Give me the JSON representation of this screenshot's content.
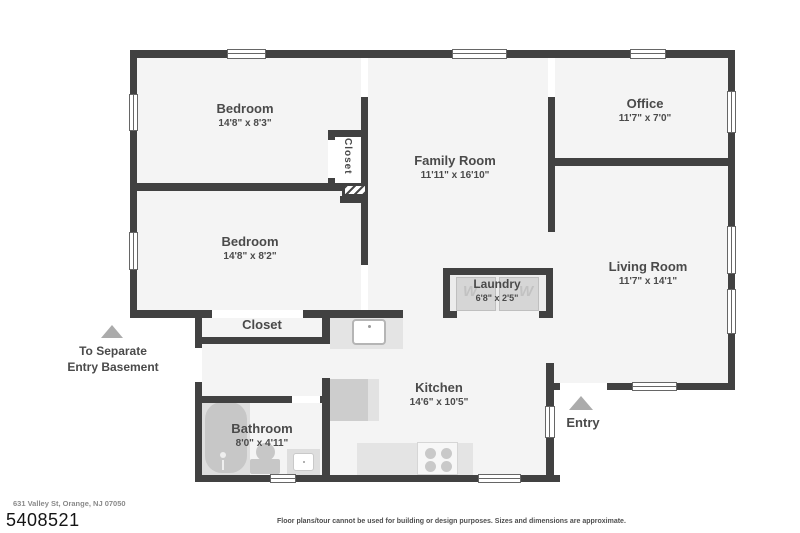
{
  "palette": {
    "wall": "#414141",
    "interior": "#f4f4f4",
    "fixture": "#c9c9c9",
    "counter": "#e4e4e4",
    "triangle": "#ababab",
    "text": "#4a4a4a"
  },
  "rooms": {
    "bedroom1": {
      "name": "Bedroom",
      "dims": "14'8\" x 8'3\""
    },
    "bedroom2": {
      "name": "Bedroom",
      "dims": "14'8\" x 8'2\""
    },
    "office": {
      "name": "Office",
      "dims": "11'7\" x 7'0\""
    },
    "family_room": {
      "name": "Family Room",
      "dims": "11'11\" x 16'10\""
    },
    "living_room": {
      "name": "Living Room",
      "dims": "11'7\" x 14'1\""
    },
    "laundry": {
      "name": "Laundry",
      "dims": "6'8\" x 2'5\""
    },
    "kitchen": {
      "name": "Kitchen",
      "dims": "14'6\" x 10'5\""
    },
    "bathroom": {
      "name": "Bathroom",
      "dims": "8'0\" x 4'11\""
    },
    "closet_hall": {
      "name": "Closet"
    },
    "closet_bedroom": {
      "name": "Closet"
    }
  },
  "annotations": {
    "basement": {
      "line1": "To Separate",
      "line2": "Entry Basement"
    },
    "entry": {
      "label": "Entry"
    },
    "washer_letter": "W",
    "dryer_letter": "W"
  },
  "footer": {
    "address": "631 Valley St, Orange, NJ 07050",
    "listing_id": "5408521",
    "disclaimer": "Floor plans/tour cannot be used for building or design purposes. Sizes and dimensions are approximate."
  }
}
